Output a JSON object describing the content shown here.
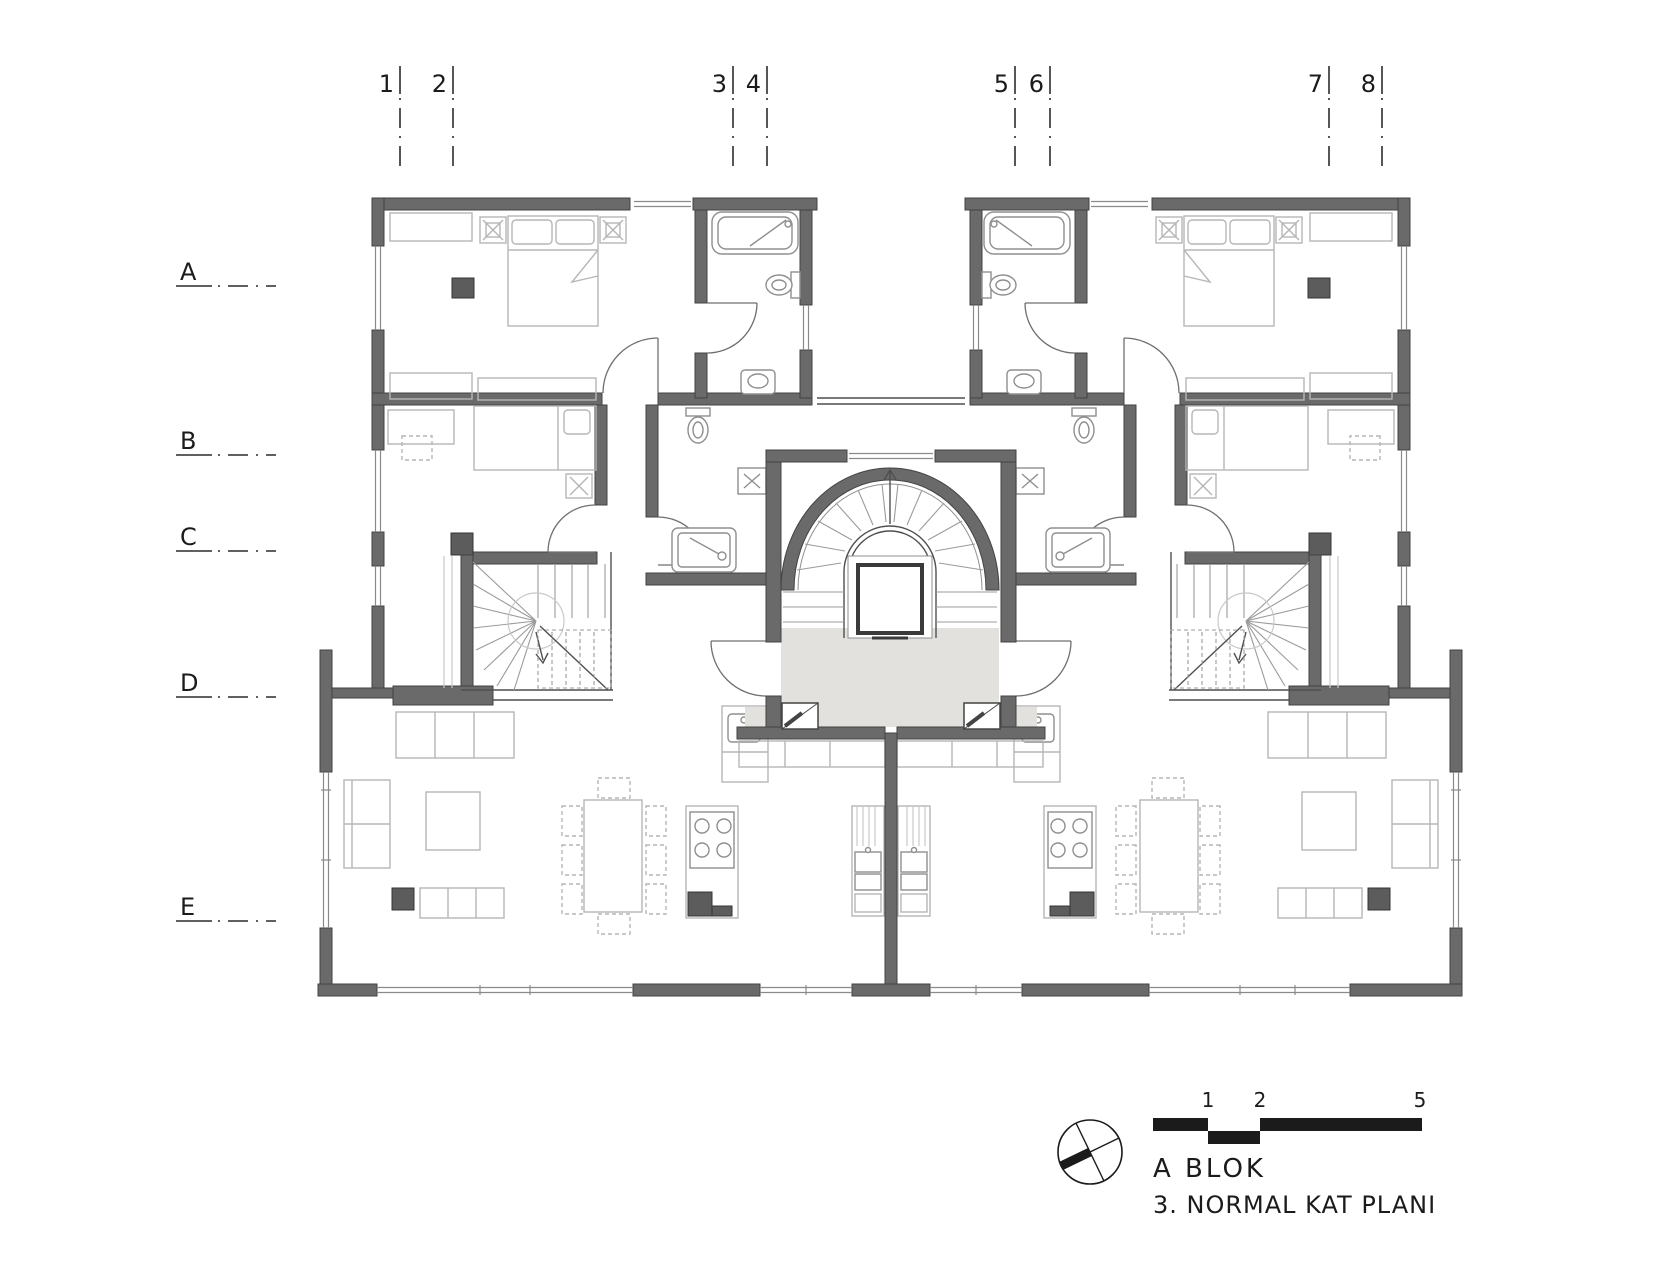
{
  "plan": {
    "grid_columns": [
      "1",
      "2",
      "3",
      "4",
      "5",
      "6",
      "7",
      "8"
    ],
    "grid_rows": [
      "A",
      "B",
      "C",
      "D",
      "E"
    ],
    "scale_bar": {
      "ticks": [
        "1",
        "2",
        "5"
      ]
    },
    "title": {
      "block": "A BLOK",
      "floor": "3. NORMAL KAT PLANI"
    },
    "compass_icon": "north-arrow-icon",
    "colors": {
      "wall": "#6a6a6a",
      "column": "#5c5c5c",
      "furniture_line": "#b6b6b6",
      "fixture_line": "#8f8f8f",
      "thin_line": "#4f4f4f",
      "landing_floor": "#e3e1de",
      "ink": "#1b1b1b"
    }
  }
}
